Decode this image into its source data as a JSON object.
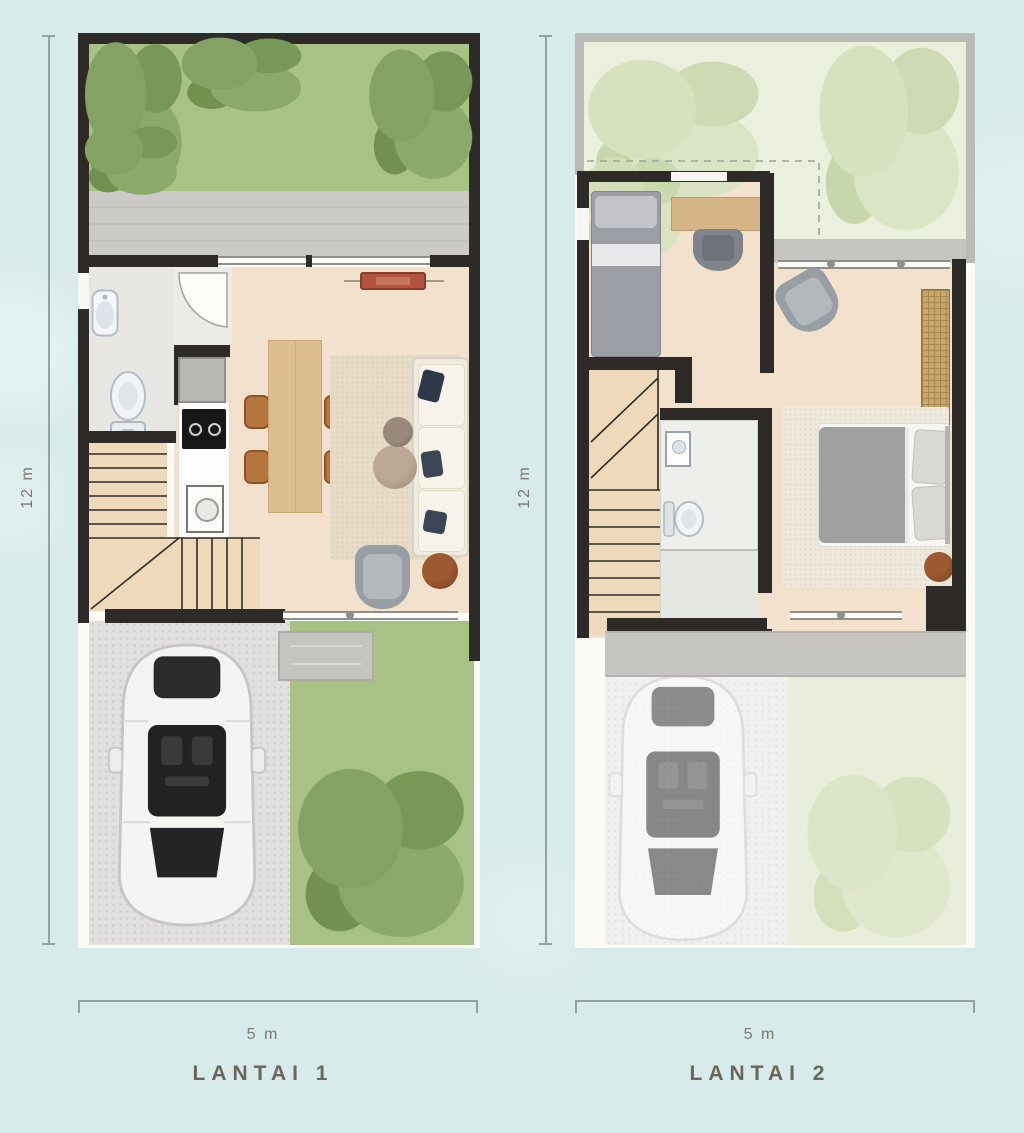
{
  "canvas": {
    "background": "#d7ebea"
  },
  "plans": [
    {
      "label": "LANTAI 1",
      "width_label": "5 m",
      "height_label": "12 m"
    },
    {
      "label": "LANTAI 2",
      "width_label": "5 m",
      "height_label": "12 m"
    }
  ],
  "colors": {
    "background": "#d7ebea",
    "wall": "#2d2a27",
    "wood_floor": "#f2e2cd",
    "bathroom_tile": "#e8e7e3",
    "garden_green": "#a8c286",
    "tree_green": "#7d9d60",
    "roof_garden_green": "#ebf0dc",
    "paving_gray": "#c9c8c4",
    "canopy_gray": "#c6c5c2",
    "wood_furniture": "#dcbd90",
    "dimension_line": "#93a3a1",
    "dimension_text": "#7e7870",
    "plan_label_text": "#6b655c"
  }
}
